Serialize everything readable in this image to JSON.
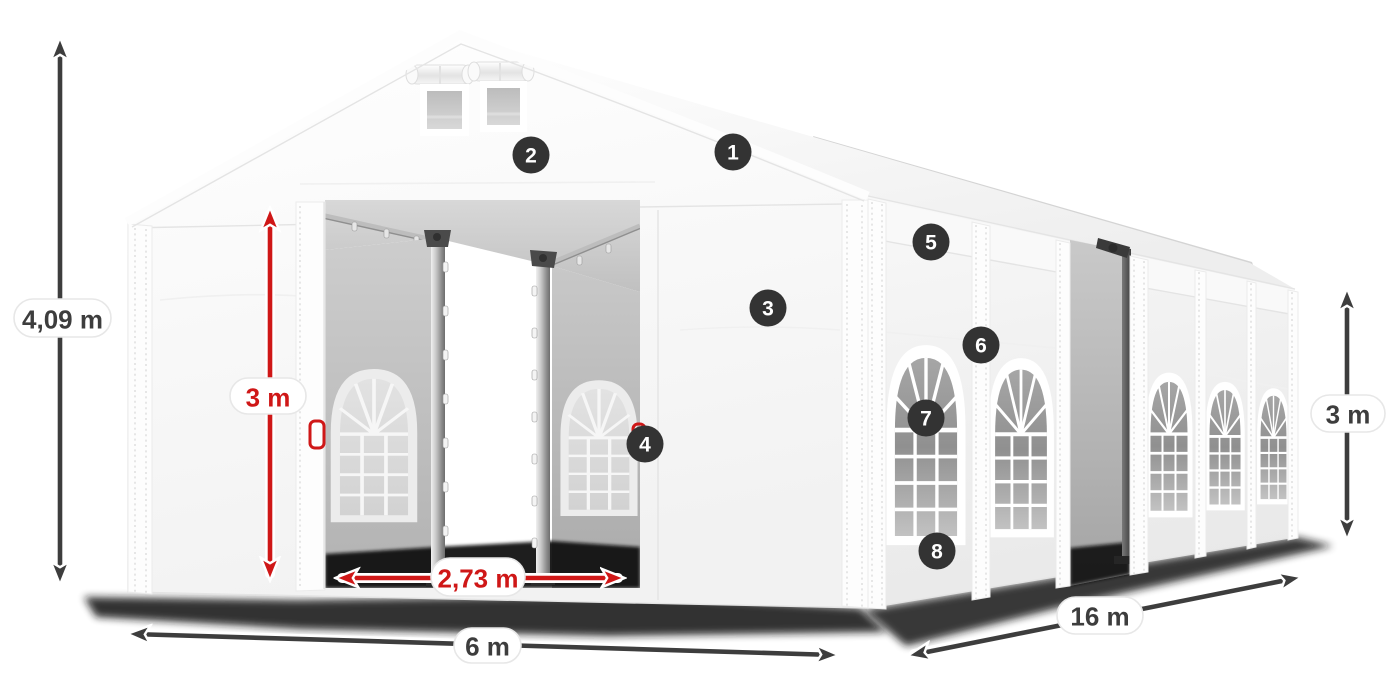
{
  "annotations": {
    "height_total": {
      "value": "4,09 m",
      "style": "dark"
    },
    "entrance_height": {
      "value": "3 m",
      "style": "red"
    },
    "entrance_width": {
      "value": "2,73 m",
      "style": "red"
    },
    "front_width": {
      "value": "6 m",
      "style": "dark"
    },
    "side_length": {
      "value": "16 m",
      "style": "dark"
    },
    "wall_height": {
      "value": "3 m",
      "style": "dark"
    }
  },
  "callouts": [
    {
      "number": "1"
    },
    {
      "number": "2"
    },
    {
      "number": "3"
    },
    {
      "number": "4"
    },
    {
      "number": "5"
    },
    {
      "number": "6"
    },
    {
      "number": "7"
    },
    {
      "number": "8"
    }
  ],
  "colors": {
    "annotation_dark": "#3d3d3d",
    "annotation_red": "#cf1717",
    "badge_bg": "#333333",
    "badge_text": "#ffffff"
  }
}
